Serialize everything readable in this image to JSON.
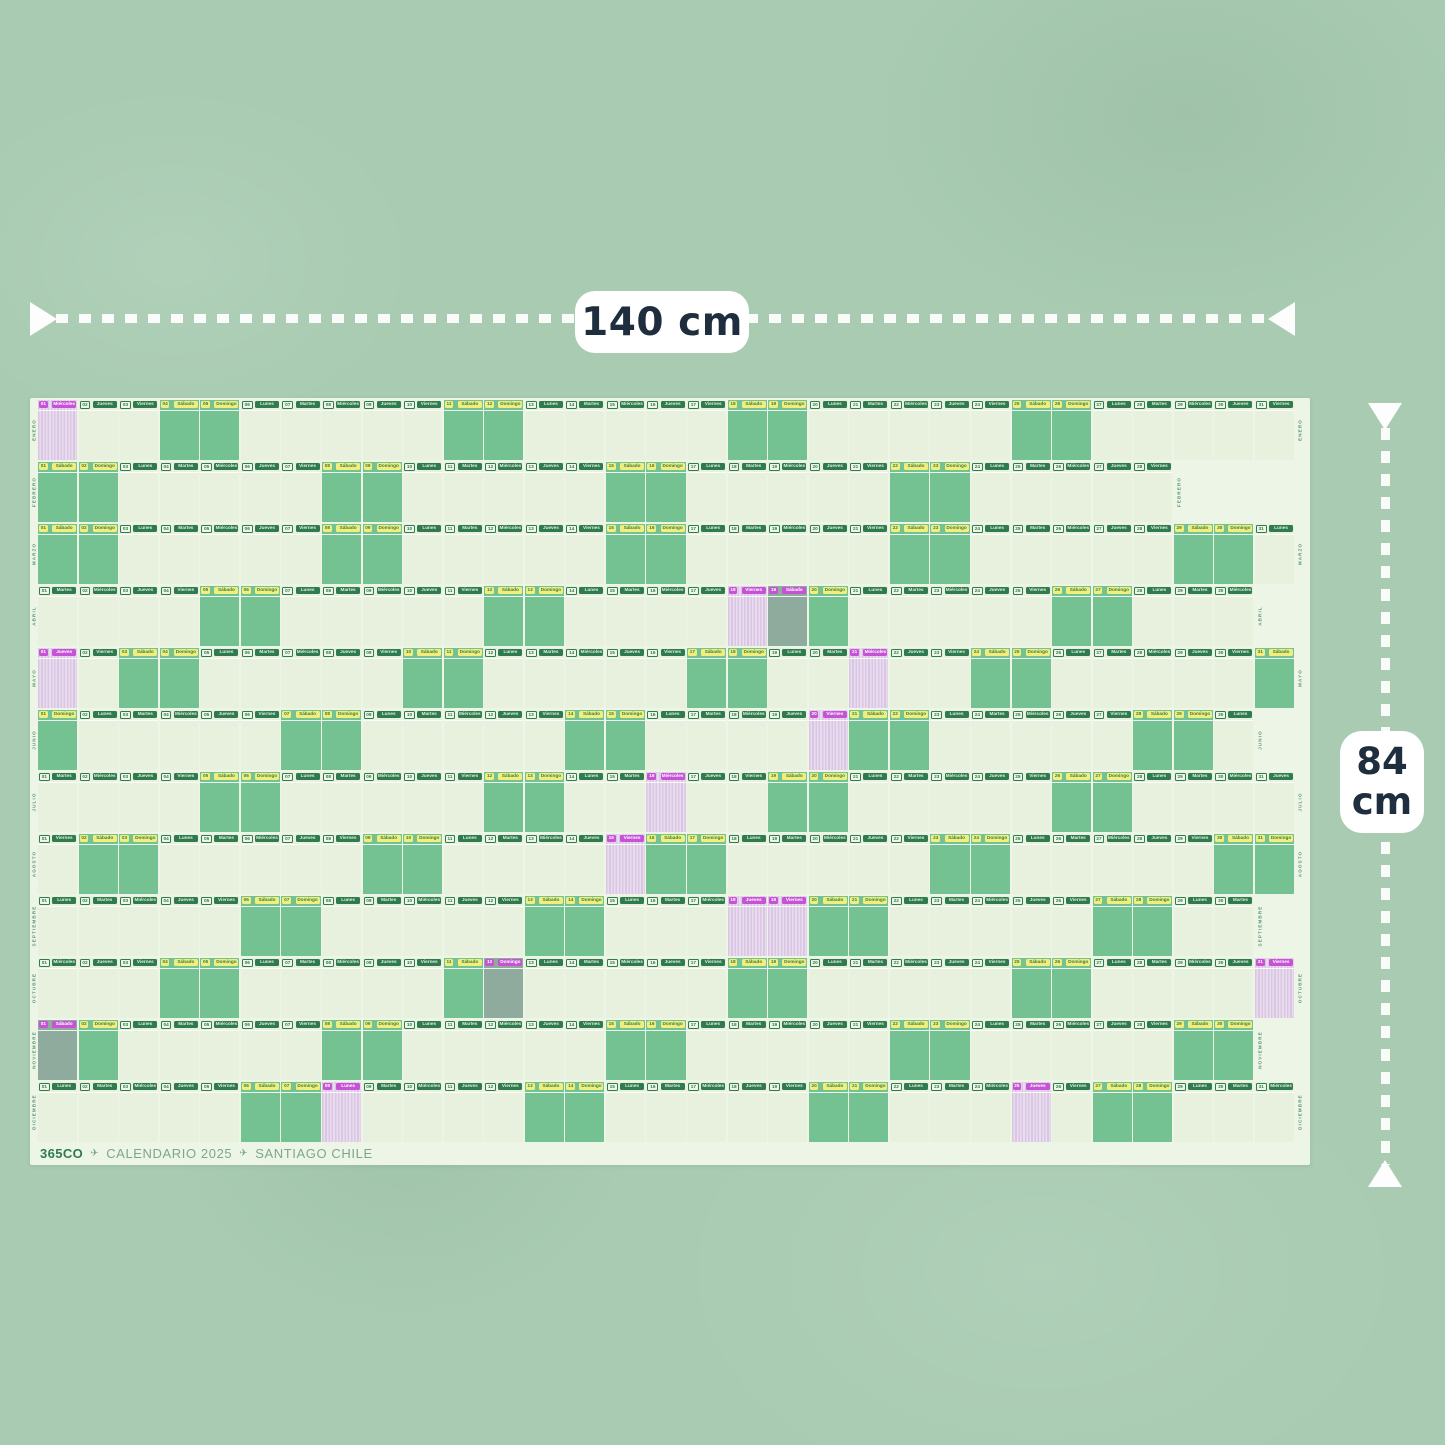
{
  "page": {
    "background_color": "#a8cbb1"
  },
  "dimensions": {
    "width_label": "140 cm",
    "height_value": "84",
    "height_unit": "cm",
    "arrow_color": "#ffffff",
    "label_text_color": "#1e2e3e"
  },
  "poster": {
    "background_color": "#edf5e6",
    "footer": {
      "brand": "365CO",
      "separator_icon": "plane-icon",
      "title": "CALENDARIO 2025",
      "location": "SANTIAGO CHILE"
    },
    "weekday_names": [
      "Lunes",
      "Martes",
      "Miércoles",
      "Jueves",
      "Viernes",
      "Sábado",
      "Domingo"
    ],
    "cell_colors": {
      "weekday": "#e7f1de",
      "weekend": "#74c191",
      "holiday_stripe_a": "#d9c6e0",
      "holiday_stripe_b": "#eadcf0",
      "holiday_weekend": "#8eab9d",
      "chip_green": "#2f7b4f",
      "chip_yellow": "#f1ee7e",
      "chip_magenta": "#c653d6",
      "month_label": "#5d9674"
    },
    "months": [
      {
        "name": "ENERO",
        "days": 31,
        "first_weekday": 3,
        "holidays": [
          1
        ]
      },
      {
        "name": "FEBRERO",
        "days": 28,
        "first_weekday": 6,
        "holidays": []
      },
      {
        "name": "MARZO",
        "days": 31,
        "first_weekday": 6,
        "holidays": []
      },
      {
        "name": "ABRIL",
        "days": 30,
        "first_weekday": 2,
        "holidays": [
          18,
          19
        ]
      },
      {
        "name": "MAYO",
        "days": 31,
        "first_weekday": 4,
        "holidays": [
          1,
          21
        ]
      },
      {
        "name": "JUNIO",
        "days": 30,
        "first_weekday": 7,
        "holidays": [
          20
        ]
      },
      {
        "name": "JULIO",
        "days": 31,
        "first_weekday": 2,
        "holidays": [
          16
        ]
      },
      {
        "name": "AGOSTO",
        "days": 31,
        "first_weekday": 5,
        "holidays": [
          15
        ]
      },
      {
        "name": "SEPTIEMBRE",
        "days": 30,
        "first_weekday": 1,
        "holidays": [
          18,
          19
        ]
      },
      {
        "name": "OCTUBRE",
        "days": 31,
        "first_weekday": 3,
        "holidays": [
          12,
          31
        ]
      },
      {
        "name": "NOVIEMBRE",
        "days": 30,
        "first_weekday": 6,
        "holidays": [
          1
        ]
      },
      {
        "name": "DICIEMBRE",
        "days": 31,
        "first_weekday": 1,
        "holidays": [
          8,
          25
        ]
      }
    ]
  }
}
